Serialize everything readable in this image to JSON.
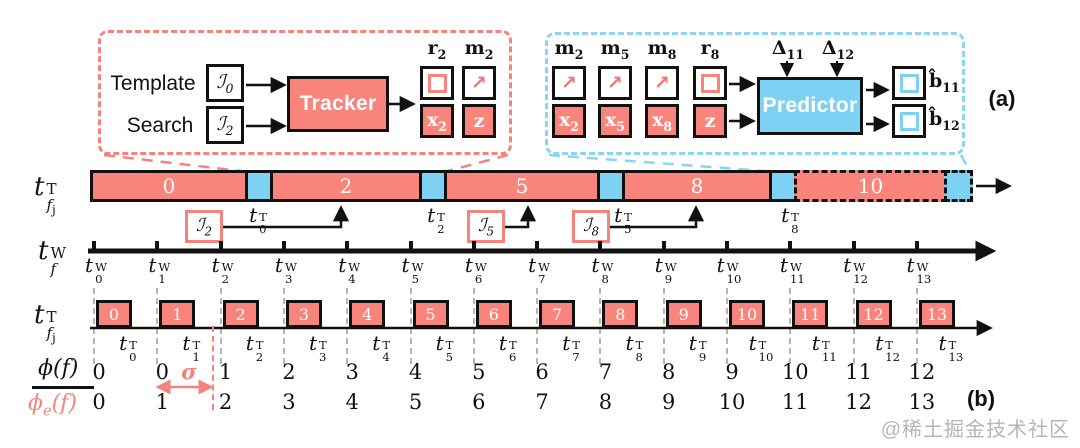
{
  "colors": {
    "pink": "#F8847C",
    "pink_dash": "#F5837B",
    "blue": "#7DD2F4",
    "blue_dash": "#8BD4F2",
    "ink": "#111111",
    "grid_gray": "#B4B4B4",
    "watermark_gray": "#B6B6B6"
  },
  "icons": {
    "motion_arrow": "↗"
  },
  "panel_tags": {
    "a": "(a)",
    "b": "(b)"
  },
  "watermark": "@稀土掘金技术社区",
  "tracker_callout": {
    "template_label": "Template",
    "search_label": "Search",
    "template_frame": {
      "glyph": "ℐ",
      "sub": "0"
    },
    "search_frame": {
      "glyph": "ℐ",
      "sub": "2"
    },
    "module_label": "Tracker",
    "outputs_top": [
      {
        "base": "r",
        "sub": "2",
        "icon": "box-outline-icon"
      },
      {
        "base": "m",
        "sub": "2",
        "icon": "motion-arrow-icon"
      }
    ],
    "outputs_bottom": [
      {
        "base": "x",
        "sub": "2"
      },
      {
        "base": "z",
        "sub": ""
      }
    ]
  },
  "predictor_callout": {
    "inputs_top": [
      {
        "base": "m",
        "sub": "2",
        "icon": "motion-arrow-icon"
      },
      {
        "base": "m",
        "sub": "5",
        "icon": "motion-arrow-icon"
      },
      {
        "base": "m",
        "sub": "8",
        "icon": "motion-arrow-icon"
      },
      {
        "base": "r",
        "sub": "8",
        "icon": "box-outline-icon"
      }
    ],
    "inputs_bottom": [
      {
        "base": "x",
        "sub": "2"
      },
      {
        "base": "x",
        "sub": "5"
      },
      {
        "base": "x",
        "sub": "8"
      },
      {
        "base": "z",
        "sub": ""
      }
    ],
    "module_label": "Predictor",
    "delta_labels": [
      {
        "base": "Δ",
        "sub": "11"
      },
      {
        "base": "Δ",
        "sub": "12"
      }
    ],
    "outputs": [
      {
        "base": "b̂",
        "sub": "11"
      },
      {
        "base": "b̂",
        "sub": "12"
      }
    ]
  },
  "gpu_timeline": {
    "axis_label": {
      "base": "t",
      "sup": "T",
      "sub": "f",
      "subsub": "j"
    },
    "segments": [
      {
        "kind": "work",
        "label": "0",
        "x": 90,
        "w": 158
      },
      {
        "kind": "gap",
        "x": 248,
        "w": 25
      },
      {
        "kind": "work",
        "label": "2",
        "x": 273,
        "w": 149
      },
      {
        "kind": "gap",
        "x": 422,
        "w": 25
      },
      {
        "kind": "work",
        "label": "5",
        "x": 447,
        "w": 153
      },
      {
        "kind": "gap",
        "x": 600,
        "w": 25
      },
      {
        "kind": "work",
        "label": "8",
        "x": 625,
        "w": 147
      },
      {
        "kind": "gap",
        "x": 772,
        "w": 25
      },
      {
        "kind": "work",
        "label": "10",
        "x": 797,
        "w": 150,
        "dashed": true
      },
      {
        "kind": "gap",
        "x": 947,
        "w": 26,
        "dashed": true
      }
    ],
    "boundary_labels": [
      {
        "base": "t",
        "sup": "T",
        "sub": "0",
        "x": 258
      },
      {
        "base": "t",
        "sup": "T",
        "sub": "2",
        "x": 436
      },
      {
        "base": "t",
        "sup": "T",
        "sub": "5",
        "x": 623
      },
      {
        "base": "t",
        "sup": "T",
        "sub": "8",
        "x": 790
      }
    ],
    "frame_arrivals": [
      {
        "glyph": "ℐ",
        "sub": "2",
        "box_x": 185
      },
      {
        "glyph": "ℐ",
        "sub": "5",
        "box_x": 467
      },
      {
        "glyph": "ℐ",
        "sub": "8",
        "box_x": 572
      }
    ]
  },
  "wall_clock_axis": {
    "axis_label": {
      "base": "t",
      "sup": "W",
      "sub": "f"
    },
    "tick_labels": [
      {
        "base": "t",
        "sup": "W",
        "sub": "0"
      },
      {
        "base": "t",
        "sup": "W",
        "sub": "1"
      },
      {
        "base": "t",
        "sup": "W",
        "sub": "2"
      },
      {
        "base": "t",
        "sup": "W",
        "sub": "3"
      },
      {
        "base": "t",
        "sup": "W",
        "sub": "4"
      },
      {
        "base": "t",
        "sup": "W",
        "sub": "5"
      },
      {
        "base": "t",
        "sup": "W",
        "sub": "6"
      },
      {
        "base": "t",
        "sup": "W",
        "sub": "7"
      },
      {
        "base": "t",
        "sup": "W",
        "sub": "8"
      },
      {
        "base": "t",
        "sup": "W",
        "sub": "9"
      },
      {
        "base": "t",
        "sup": "W",
        "sub": "10"
      },
      {
        "base": "t",
        "sup": "W",
        "sub": "11"
      },
      {
        "base": "t",
        "sup": "W",
        "sub": "12"
      },
      {
        "base": "t",
        "sup": "W",
        "sub": "13"
      }
    ]
  },
  "frame_timeline": {
    "axis_label": {
      "base": "t",
      "sup": "T",
      "sub": "f",
      "subsub": "j"
    },
    "frame_numbers": [
      "0",
      "1",
      "2",
      "3",
      "4",
      "5",
      "6",
      "7",
      "8",
      "9",
      "10",
      "11",
      "12",
      "13"
    ],
    "tick_labels": [
      {
        "base": "t",
        "sup": "T",
        "sub": "0"
      },
      {
        "base": "t",
        "sup": "T",
        "sub": "1"
      },
      {
        "base": "t",
        "sup": "T",
        "sub": "2"
      },
      {
        "base": "t",
        "sup": "T",
        "sub": "3"
      },
      {
        "base": "t",
        "sup": "T",
        "sub": "4"
      },
      {
        "base": "t",
        "sup": "T",
        "sub": "5"
      },
      {
        "base": "t",
        "sup": "T",
        "sub": "6"
      },
      {
        "base": "t",
        "sup": "T",
        "sub": "7"
      },
      {
        "base": "t",
        "sup": "T",
        "sub": "8"
      },
      {
        "base": "t",
        "sup": "T",
        "sub": "9"
      },
      {
        "base": "t",
        "sup": "T",
        "sub": "10"
      },
      {
        "base": "t",
        "sup": "T",
        "sub": "11"
      },
      {
        "base": "t",
        "sup": "T",
        "sub": "12"
      },
      {
        "base": "t",
        "sup": "T",
        "sub": "13"
      }
    ]
  },
  "mapping_rows": {
    "numerator": {
      "name": "ϕ",
      "arg": "(f)"
    },
    "denominator": {
      "name": "ϕ",
      "sub": "e",
      "arg": "(f)"
    },
    "sigma": "σ",
    "phi_values": [
      "0",
      "0",
      "1",
      "2",
      "3",
      "4",
      "5",
      "6",
      "7",
      "8",
      "9",
      "10",
      "11",
      "12"
    ],
    "phi_e_values": [
      "0",
      "1",
      "2",
      "3",
      "4",
      "5",
      "6",
      "7",
      "8",
      "9",
      "10",
      "11",
      "12",
      "13"
    ]
  }
}
